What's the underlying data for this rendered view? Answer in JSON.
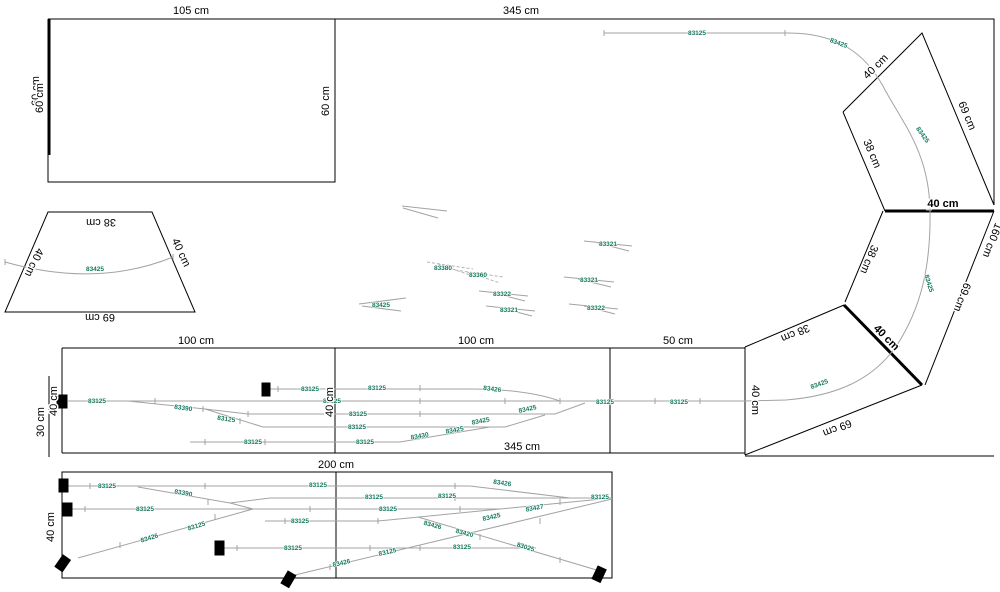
{
  "app": {
    "title": "track-plan-canvas"
  },
  "colors": {
    "background": "#ffffff",
    "outline": "#000000",
    "track": "#a3a3a3",
    "part_label": "#15795f",
    "buffer": "#000000"
  },
  "dim_labels": [
    {
      "t": "105 cm",
      "x": 191,
      "y": 14
    },
    {
      "t": "345 cm",
      "x": 521,
      "y": 14
    },
    {
      "t": "60 cm",
      "x": 39,
      "y": 91,
      "r": -90
    },
    {
      "t": "60 cm",
      "x": 43,
      "y": 98,
      "r": -90
    },
    {
      "t": "60 cm",
      "x": 329,
      "y": 101,
      "r": -90
    },
    {
      "t": "38 cm",
      "x": 101,
      "y": 219,
      "r": 180
    },
    {
      "t": "40 cm",
      "x": 31,
      "y": 261,
      "r": 115
    },
    {
      "t": "40 cm",
      "x": 178,
      "y": 254,
      "r": 65
    },
    {
      "t": "69 cm",
      "x": 100,
      "y": 314,
      "r": 180
    },
    {
      "t": "100 cm",
      "x": 196,
      "y": 344
    },
    {
      "t": "30 cm",
      "x": 44,
      "y": 422,
      "r": -90
    },
    {
      "t": "40 cm",
      "x": 57,
      "y": 401,
      "r": -90
    },
    {
      "t": "40 cm",
      "x": 333,
      "y": 402,
      "r": -90
    },
    {
      "t": "100 cm",
      "x": 476,
      "y": 344
    },
    {
      "t": "345 cm",
      "x": 522,
      "y": 450
    },
    {
      "t": "50 cm",
      "x": 678,
      "y": 344
    },
    {
      "t": "40 cm",
      "x": 752,
      "y": 400,
      "r": 90
    },
    {
      "t": "200 cm",
      "x": 336,
      "y": 468
    },
    {
      "t": "40 cm",
      "x": 54,
      "y": 527,
      "r": -90
    },
    {
      "t": "40 cm",
      "x": 878,
      "y": 69,
      "r": -45
    },
    {
      "t": "69 cm",
      "x": 964,
      "y": 117,
      "r": 67
    },
    {
      "t": "38 cm",
      "x": 869,
      "y": 155,
      "r": 67
    },
    {
      "t": "40 cm",
      "x": 943,
      "y": 207,
      "b": 1
    },
    {
      "t": "38 cm",
      "x": 866,
      "y": 258,
      "r": 113
    },
    {
      "t": "160 cm",
      "x": 989,
      "y": 239,
      "r": 111
    },
    {
      "t": "69 cm",
      "x": 959,
      "y": 296,
      "r": 111
    },
    {
      "t": "40 cm",
      "x": 884,
      "y": 340,
      "r": 45,
      "b": 1
    },
    {
      "t": "38 cm",
      "x": 794,
      "y": 330,
      "r": 157
    },
    {
      "t": "69 cm",
      "x": 836,
      "y": 425,
      "r": 158
    }
  ],
  "part_labels": [
    {
      "t": "83125",
      "x": 697,
      "y": 35
    },
    {
      "t": "83425",
      "x": 838,
      "y": 45,
      "r": 20
    },
    {
      "t": "83425",
      "x": 921,
      "y": 136,
      "r": 55
    },
    {
      "t": "83425",
      "x": 927,
      "y": 284,
      "r": 73
    },
    {
      "t": "83425",
      "x": 820,
      "y": 386,
      "r": -20
    },
    {
      "t": "83425",
      "x": 95,
      "y": 271
    },
    {
      "t": "83125",
      "x": 97,
      "y": 403
    },
    {
      "t": "83125",
      "x": 332,
      "y": 403
    },
    {
      "t": "83390",
      "x": 183,
      "y": 410,
      "r": 8
    },
    {
      "t": "83125",
      "x": 226,
      "y": 421,
      "r": 8
    },
    {
      "t": "83125",
      "x": 253,
      "y": 444
    },
    {
      "t": "83125",
      "x": 310,
      "y": 391
    },
    {
      "t": "83125",
      "x": 377,
      "y": 390
    },
    {
      "t": "83426",
      "x": 492,
      "y": 391,
      "r": 7
    },
    {
      "t": "83125",
      "x": 358,
      "y": 416
    },
    {
      "t": "83425",
      "x": 528,
      "y": 411,
      "r": -12
    },
    {
      "t": "83125",
      "x": 357,
      "y": 429
    },
    {
      "t": "83425",
      "x": 481,
      "y": 423,
      "r": -11
    },
    {
      "t": "83125",
      "x": 365,
      "y": 444
    },
    {
      "t": "83430",
      "x": 420,
      "y": 438,
      "r": -10
    },
    {
      "t": "83425",
      "x": 455,
      "y": 432,
      "r": -10
    },
    {
      "t": "83125",
      "x": 605,
      "y": 404
    },
    {
      "t": "83125",
      "x": 679,
      "y": 404
    },
    {
      "t": "83125",
      "x": 107,
      "y": 488
    },
    {
      "t": "83125",
      "x": 318,
      "y": 487
    },
    {
      "t": "83426",
      "x": 502,
      "y": 485,
      "r": 8
    },
    {
      "t": "83390",
      "x": 183,
      "y": 495,
      "r": 10
    },
    {
      "t": "83125",
      "x": 374,
      "y": 499
    },
    {
      "t": "83125",
      "x": 447,
      "y": 498
    },
    {
      "t": "83125",
      "x": 600,
      "y": 499
    },
    {
      "t": "83125",
      "x": 145,
      "y": 511
    },
    {
      "t": "83125",
      "x": 388,
      "y": 511
    },
    {
      "t": "83125",
      "x": 300,
      "y": 523
    },
    {
      "t": "83427",
      "x": 535,
      "y": 510,
      "r": -11
    },
    {
      "t": "83125",
      "x": 293,
      "y": 550
    },
    {
      "t": "83125",
      "x": 462,
      "y": 549
    },
    {
      "t": "83426",
      "x": 150,
      "y": 540,
      "r": -17
    },
    {
      "t": "83125",
      "x": 197,
      "y": 528,
      "r": -17
    },
    {
      "t": "83426",
      "x": 342,
      "y": 565,
      "r": -13
    },
    {
      "t": "83125",
      "x": 388,
      "y": 554,
      "r": -13
    },
    {
      "t": "83425",
      "x": 492,
      "y": 519,
      "r": -13
    },
    {
      "t": "83426",
      "x": 432,
      "y": 527,
      "r": 15
    },
    {
      "t": "83420",
      "x": 464,
      "y": 535,
      "r": 15
    },
    {
      "t": "83025",
      "x": 525,
      "y": 549,
      "r": 17
    },
    {
      "t": "83380",
      "x": 443,
      "y": 270
    },
    {
      "t": "83360",
      "x": 478,
      "y": 277
    },
    {
      "t": "83321",
      "x": 608,
      "y": 246
    },
    {
      "t": "83321",
      "x": 589,
      "y": 282
    },
    {
      "t": "83322",
      "x": 596,
      "y": 310
    },
    {
      "t": "83322",
      "x": 502,
      "y": 296
    },
    {
      "t": "83321",
      "x": 509,
      "y": 312
    },
    {
      "t": "83425",
      "x": 381,
      "y": 307
    }
  ],
  "buffers": [
    {
      "x": 57,
      "y": 395,
      "width": 10,
      "height": 13
    },
    {
      "x": 262,
      "y": 383,
      "width": 8,
      "height": 13
    },
    {
      "x": 59,
      "y": 479,
      "width": 9,
      "height": 13
    },
    {
      "x": 63,
      "y": 503,
      "width": 9,
      "height": 13
    },
    {
      "x": 215,
      "y": 541,
      "width": 9,
      "height": 14
    },
    {
      "x": 63,
      "y": 555,
      "width": 9,
      "height": 14,
      "r": 35
    },
    {
      "x": 288,
      "y": 571,
      "width": 9,
      "height": 14,
      "r": 30
    },
    {
      "x": 598,
      "y": 566,
      "width": 9,
      "height": 14,
      "r": 25
    }
  ]
}
